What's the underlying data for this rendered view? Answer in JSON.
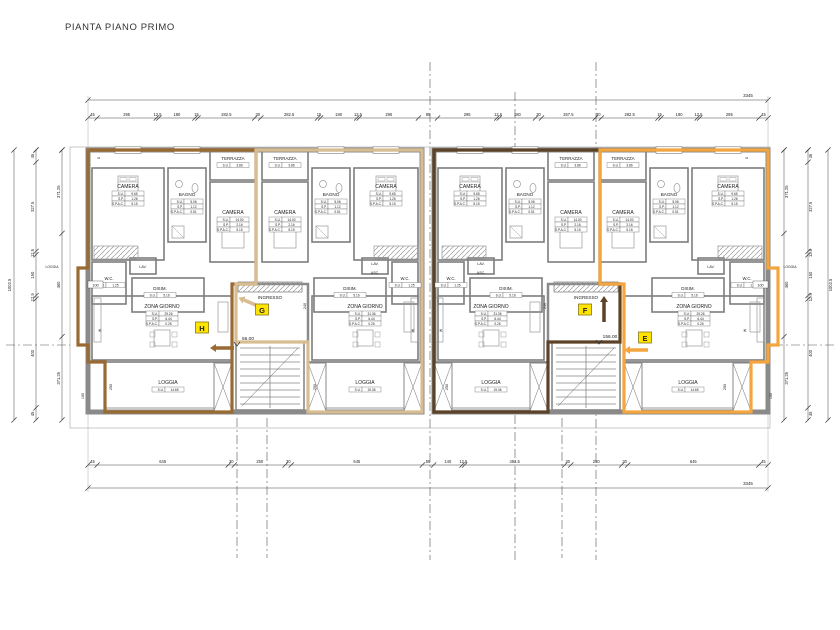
{
  "title": "PIANTA PIANO PRIMO",
  "colors": {
    "unit_h": "#9a6a33",
    "unit_g": "#d9bd92",
    "unit_f": "#5c4227",
    "unit_e": "#f4a53d",
    "wall": "#8a8a8a",
    "thin": "#777777",
    "marker_bg": "#ffe400",
    "text": "#222222"
  },
  "labels": {
    "ingresso": "INGRESSO",
    "side_loggia": "LOGGIA",
    "kitchen": "K",
    "section_mark": "S"
  },
  "levels": {
    "left": "56.00",
    "right": "156.00"
  },
  "units": [
    {
      "id": "H",
      "rooms": {
        "camera_small": {
          "label": "CAMERA",
          "table": [
            [
              "S.U.",
              "9.65"
            ],
            [
              "S.P.",
              "1.26"
            ],
            [
              "S.P.A.C.",
              "5.15"
            ]
          ]
        },
        "camera_big": {
          "label": "CAMERA",
          "table": [
            [
              "S.U.",
              "14.00"
            ],
            [
              "S.P.",
              "2.16"
            ],
            [
              "S.P.A.C.",
              "5.15"
            ]
          ]
        },
        "bagno": {
          "label": "BAGNO",
          "table": [
            [
              "S.U.",
              "5.06"
            ],
            [
              "S.P.",
              "1.12"
            ],
            [
              "S.P.A.C.",
              "0.51"
            ]
          ]
        },
        "terrazza": {
          "label": "TERRAZZA",
          "table": [
            [
              "S.U.",
              "3.86"
            ]
          ]
        },
        "wc": {
          "label": "W.C.",
          "table": [
            [
              "S.U.",
              "1.25"
            ]
          ]
        },
        "lav": {
          "label": "LAV."
        },
        "disim": {
          "label": "DISIM.",
          "table": [
            [
              "S.U.",
              "5.16"
            ]
          ]
        },
        "zona": {
          "label": "ZONA GIORNO",
          "table": [
            [
              "S.U.",
              "29.26"
            ],
            [
              "S.P.",
              "6.44"
            ],
            [
              "S.P.A.C.",
              "0.26"
            ]
          ]
        },
        "loggia": {
          "label": "LOGGIA",
          "table": [
            [
              "S.U.",
              "14.65"
            ]
          ]
        }
      }
    },
    {
      "id": "G",
      "rooms": {
        "camera_small": {
          "label": "CAMERA",
          "table": [
            [
              "S.U.",
              "9.65"
            ],
            [
              "S.P.",
              "1.26"
            ],
            [
              "S.P.A.C.",
              "5.15"
            ]
          ]
        },
        "camera_big": {
          "label": "CAMERA",
          "table": [
            [
              "S.U.",
              "14.00"
            ],
            [
              "S.P.",
              "2.16"
            ],
            [
              "S.P.A.C.",
              "5.15"
            ]
          ]
        },
        "bagno": {
          "label": "BAGNO",
          "table": [
            [
              "S.U.",
              "5.06"
            ],
            [
              "S.P.",
              "1.12"
            ],
            [
              "S.P.A.C.",
              "0.51"
            ]
          ]
        },
        "terrazza": {
          "label": "TERRAZZA",
          "table": [
            [
              "S.U.",
              "3.86"
            ]
          ]
        },
        "wc": {
          "label": "W.C.",
          "table": [
            [
              "S.U.",
              "1.25"
            ]
          ]
        },
        "lav": {
          "label": "LAV."
        },
        "asc": {
          "label": "ASC."
        },
        "disim": {
          "label": "DISIM.",
          "table": [
            [
              "S.U.",
              "5.16"
            ]
          ]
        },
        "zona": {
          "label": "ZONA GIORNO",
          "table": [
            [
              "S.U.",
              "31.36"
            ],
            [
              "S.P.",
              "6.44"
            ],
            [
              "S.P.A.C.",
              "0.26"
            ]
          ]
        },
        "loggia": {
          "label": "LOGGIA",
          "table": [
            [
              "S.U.",
              "19.36"
            ]
          ]
        }
      }
    },
    {
      "id": "F",
      "rooms": {
        "camera_small": {
          "label": "CAMERA",
          "table": [
            [
              "S.U.",
              "9.65"
            ],
            [
              "S.P.",
              "1.26"
            ],
            [
              "S.P.A.C.",
              "5.15"
            ]
          ]
        },
        "camera_big": {
          "label": "CAMERA",
          "table": [
            [
              "S.U.",
              "14.00"
            ],
            [
              "S.P.",
              "2.16"
            ],
            [
              "S.P.A.C.",
              "5.15"
            ]
          ]
        },
        "bagno": {
          "label": "BAGNO",
          "table": [
            [
              "S.U.",
              "5.06"
            ],
            [
              "S.P.",
              "1.12"
            ],
            [
              "S.P.A.C.",
              "0.51"
            ]
          ]
        },
        "terrazza": {
          "label": "TERRAZZA",
          "table": [
            [
              "S.U.",
              "3.86"
            ]
          ]
        },
        "wc": {
          "label": "W.C.",
          "table": [
            [
              "S.U.",
              "1.25"
            ]
          ]
        },
        "lav": {
          "label": "LAV."
        },
        "asc": {
          "label": "ASC."
        },
        "disim": {
          "label": "DISIM.",
          "table": [
            [
              "S.U.",
              "5.16"
            ]
          ]
        },
        "zona": {
          "label": "ZONA GIORNO",
          "table": [
            [
              "S.U.",
              "31.36"
            ],
            [
              "S.P.",
              "6.44"
            ],
            [
              "S.P.A.C.",
              "0.26"
            ]
          ]
        },
        "loggia": {
          "label": "LOGGIA",
          "table": [
            [
              "S.U.",
              "19.36"
            ]
          ]
        }
      }
    },
    {
      "id": "E",
      "rooms": {
        "camera_small": {
          "label": "CAMERA",
          "table": [
            [
              "S.U.",
              "9.65"
            ],
            [
              "S.P.",
              "1.26"
            ],
            [
              "S.P.A.C.",
              "5.15"
            ]
          ]
        },
        "camera_big": {
          "label": "CAMERA",
          "table": [
            [
              "S.U.",
              "14.00"
            ],
            [
              "S.P.",
              "2.16"
            ],
            [
              "S.P.A.C.",
              "5.15"
            ]
          ]
        },
        "bagno": {
          "label": "BAGNO",
          "table": [
            [
              "S.U.",
              "5.06"
            ],
            [
              "S.P.",
              "1.12"
            ],
            [
              "S.P.A.C.",
              "0.51"
            ]
          ]
        },
        "terrazza": {
          "label": "TERRAZZA",
          "table": [
            [
              "S.U.",
              "3.86"
            ]
          ]
        },
        "wc": {
          "label": "W.C.",
          "table": [
            [
              "S.U.",
              "1.25"
            ]
          ]
        },
        "lav": {
          "label": "LAV."
        },
        "disim": {
          "label": "DISIM.",
          "table": [
            [
              "S.U.",
              "5.16"
            ]
          ]
        },
        "zona": {
          "label": "ZONA GIORNO",
          "table": [
            [
              "S.U.",
              "29.26"
            ],
            [
              "S.P.",
              "6.44"
            ],
            [
              "S.P.A.C.",
              "0.26"
            ]
          ]
        },
        "loggia": {
          "label": "LOGGIA",
          "table": [
            [
              "S.U.",
              "14.65"
            ]
          ]
        }
      }
    }
  ],
  "dims": {
    "top_total": "3345",
    "bottom_total": "3345",
    "top": [
      "45",
      "295",
      "12.5",
      "180",
      "15",
      "282.5",
      "30",
      "282.5",
      "15",
      "180",
      "12.5",
      "295",
      "95",
      "295",
      "12.5",
      "180",
      "30",
      "267.5",
      "30",
      "282.5",
      "15",
      "180",
      "12.5",
      "295",
      "45"
    ],
    "bottom": [
      "45",
      "645",
      "30",
      "250",
      "30",
      "645",
      "55",
      "140",
      "12.5",
      "492.5",
      "30",
      "250",
      "30",
      "645",
      "45"
    ],
    "left_outer": "1002.5",
    "right_outer": "1002.5",
    "left_mid": [
      "45",
      "327.5",
      "12.5",
      "150",
      "12.5",
      "400",
      "45"
    ],
    "right_mid": [
      "45",
      "327.5",
      "12.5",
      "150",
      "12.5",
      "400",
      "45"
    ],
    "left_inner": [
      "371.25",
      "460",
      "371.25"
    ],
    "right_inner": [
      "371.25",
      "460",
      "371.25"
    ],
    "small_100": "100",
    "small_250": "250",
    "small_240": "240"
  }
}
